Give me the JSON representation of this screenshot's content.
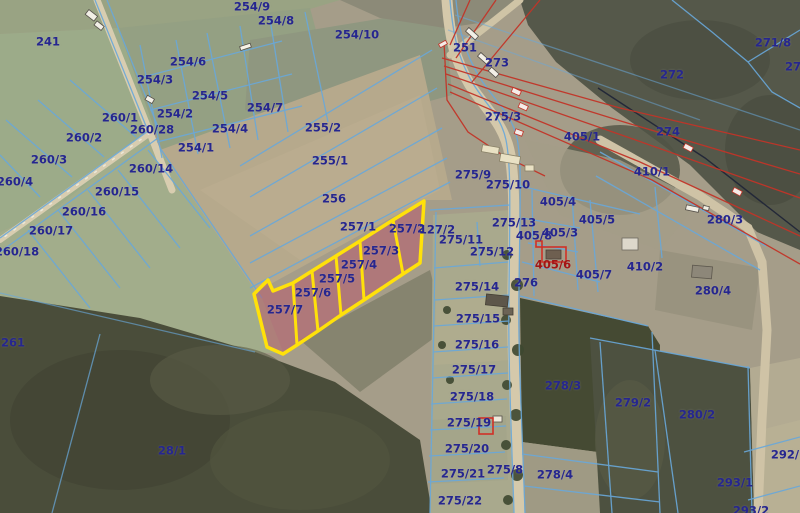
{
  "map": {
    "description": "Cadastral parcel map over aerial orthophoto",
    "colors": {
      "parcel_line_blue": "#69a8da",
      "label_blue": "#26268f",
      "label_red": "#a31515",
      "utility_line_red": "#c23428",
      "highlight_outline_yellow": "#ffe10a",
      "highlight_fill_pink": "#b85a6d",
      "road_tan": "#d5c9ab",
      "forest_dark": "#4a4d3a",
      "field_green": "#9cab89",
      "field_beige": "#b6a98c"
    },
    "highlighted_parcels": [
      "257/2",
      "257/3",
      "257/4",
      "257/5",
      "257/6",
      "257/7"
    ],
    "labels": [
      {
        "text": "241",
        "x": 48,
        "y": 42
      },
      {
        "text": "254/9",
        "x": 252,
        "y": 7
      },
      {
        "text": "254/8",
        "x": 276,
        "y": 21
      },
      {
        "text": "254/10",
        "x": 357,
        "y": 35
      },
      {
        "text": "251",
        "x": 465,
        "y": 48
      },
      {
        "text": "271/8",
        "x": 773,
        "y": 43
      },
      {
        "text": "27",
        "x": 793,
        "y": 67
      },
      {
        "text": "273",
        "x": 497,
        "y": 63
      },
      {
        "text": "272",
        "x": 672,
        "y": 75
      },
      {
        "text": "254/6",
        "x": 188,
        "y": 62
      },
      {
        "text": "254/3",
        "x": 155,
        "y": 80
      },
      {
        "text": "254/5",
        "x": 210,
        "y": 96
      },
      {
        "text": "254/7",
        "x": 265,
        "y": 108
      },
      {
        "text": "275/3",
        "x": 503,
        "y": 117
      },
      {
        "text": "260/1",
        "x": 120,
        "y": 118
      },
      {
        "text": "254/2",
        "x": 175,
        "y": 114
      },
      {
        "text": "255/2",
        "x": 323,
        "y": 128
      },
      {
        "text": "260/28",
        "x": 152,
        "y": 130
      },
      {
        "text": "254/4",
        "x": 230,
        "y": 129
      },
      {
        "text": "274",
        "x": 668,
        "y": 132
      },
      {
        "text": "405/1",
        "x": 582,
        "y": 137
      },
      {
        "text": "260/2",
        "x": 84,
        "y": 138
      },
      {
        "text": "254/1",
        "x": 196,
        "y": 148
      },
      {
        "text": "260/3",
        "x": 49,
        "y": 160
      },
      {
        "text": "255/1",
        "x": 330,
        "y": 161
      },
      {
        "text": "260/14",
        "x": 151,
        "y": 169
      },
      {
        "text": "410/1",
        "x": 652,
        "y": 172
      },
      {
        "text": "275/9",
        "x": 473,
        "y": 175
      },
      {
        "text": "260/4",
        "x": 15,
        "y": 182
      },
      {
        "text": "275/10",
        "x": 508,
        "y": 185
      },
      {
        "text": "260/15",
        "x": 117,
        "y": 192
      },
      {
        "text": "256",
        "x": 334,
        "y": 199
      },
      {
        "text": "405/4",
        "x": 558,
        "y": 202
      },
      {
        "text": "260/16",
        "x": 84,
        "y": 212
      },
      {
        "text": "280/3",
        "x": 725,
        "y": 220
      },
      {
        "text": "405/5",
        "x": 597,
        "y": 220
      },
      {
        "text": "275/13",
        "x": 514,
        "y": 223
      },
      {
        "text": "257/1",
        "x": 358,
        "y": 227
      },
      {
        "text": "257/2",
        "x": 407,
        "y": 229
      },
      {
        "text": "127/2",
        "x": 437,
        "y": 230
      },
      {
        "text": "260/17",
        "x": 51,
        "y": 231
      },
      {
        "text": "405/8",
        "x": 534,
        "y": 236
      },
      {
        "text": "405/3",
        "x": 560,
        "y": 233
      },
      {
        "text": "275/11",
        "x": 461,
        "y": 240
      },
      {
        "text": "260/18",
        "x": 17,
        "y": 252
      },
      {
        "text": "257/3",
        "x": 381,
        "y": 251
      },
      {
        "text": "275/12",
        "x": 492,
        "y": 252
      },
      {
        "text": "257/4",
        "x": 359,
        "y": 265
      },
      {
        "text": "405/6",
        "x": 553,
        "y": 265,
        "color": "red"
      },
      {
        "text": "410/2",
        "x": 645,
        "y": 267
      },
      {
        "text": "405/7",
        "x": 594,
        "y": 275
      },
      {
        "text": "257/5",
        "x": 337,
        "y": 279
      },
      {
        "text": "276",
        "x": 526,
        "y": 283
      },
      {
        "text": "275/14",
        "x": 477,
        "y": 287
      },
      {
        "text": "280/4",
        "x": 713,
        "y": 291
      },
      {
        "text": "257/6",
        "x": 313,
        "y": 293
      },
      {
        "text": "257/7",
        "x": 285,
        "y": 310
      },
      {
        "text": "275/15",
        "x": 478,
        "y": 319
      },
      {
        "text": "261",
        "x": 13,
        "y": 343
      },
      {
        "text": "275/16",
        "x": 477,
        "y": 345
      },
      {
        "text": "275/17",
        "x": 474,
        "y": 370
      },
      {
        "text": "278/3",
        "x": 563,
        "y": 386
      },
      {
        "text": "275/18",
        "x": 472,
        "y": 397
      },
      {
        "text": "279/2",
        "x": 633,
        "y": 403
      },
      {
        "text": "280/2",
        "x": 697,
        "y": 415
      },
      {
        "text": "275/19",
        "x": 469,
        "y": 423
      },
      {
        "text": "275/20",
        "x": 467,
        "y": 449
      },
      {
        "text": "28/1",
        "x": 172,
        "y": 451
      },
      {
        "text": "292/2",
        "x": 789,
        "y": 455
      },
      {
        "text": "275/21",
        "x": 463,
        "y": 474
      },
      {
        "text": "275/8",
        "x": 505,
        "y": 470
      },
      {
        "text": "278/4",
        "x": 555,
        "y": 475
      },
      {
        "text": "293/1",
        "x": 735,
        "y": 483
      },
      {
        "text": "275/22",
        "x": 460,
        "y": 501
      },
      {
        "text": "293/2",
        "x": 751,
        "y": 511
      }
    ]
  }
}
